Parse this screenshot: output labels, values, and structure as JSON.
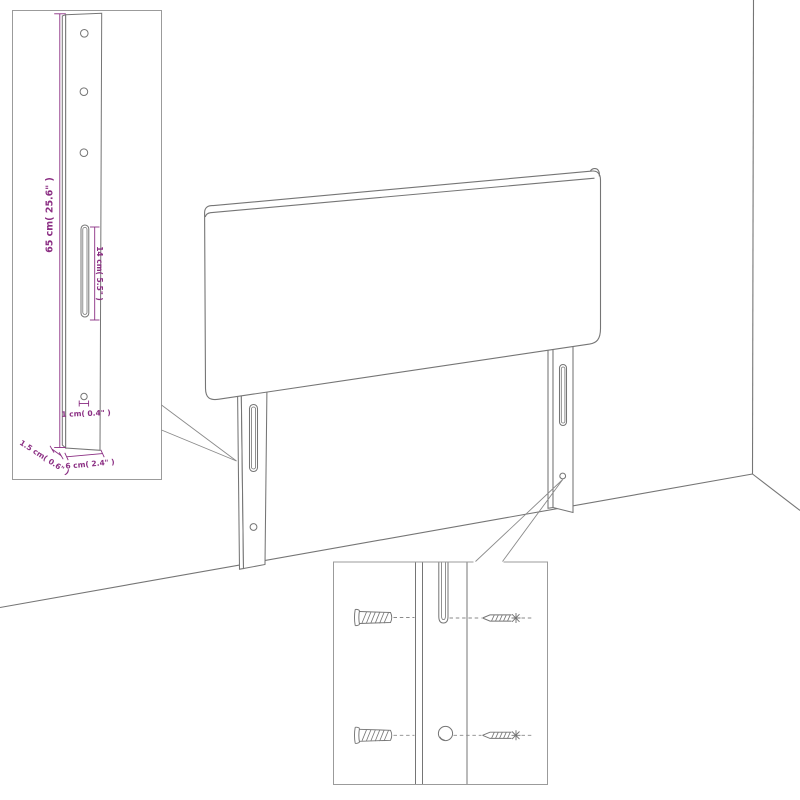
{
  "figure": {
    "kind": "furniture-dimension-diagram"
  },
  "dimension_labels": {
    "leg_height": "65 cm( 25.6\" )",
    "slot_length": "14 cm( 5.5\" )",
    "hole_diameter": "1 cm( 0.4\" )",
    "leg_thickness": "1.5 cm( 0.6\" )",
    "leg_width": "6 cm( 2.4\" )"
  },
  "colors": {
    "dimension_text": "#8b2e83",
    "line_art": "#757575",
    "inset_border": "#9b9b9b",
    "background": "#ffffff"
  }
}
